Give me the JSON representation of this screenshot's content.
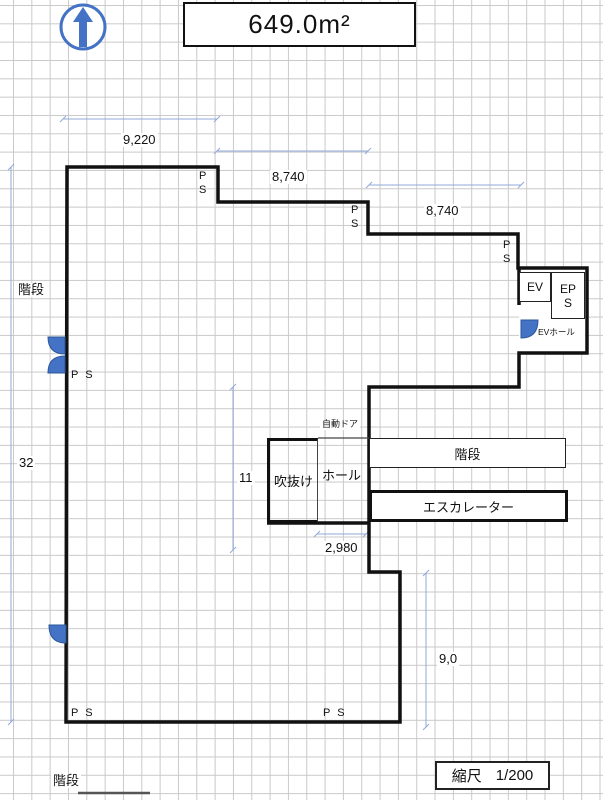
{
  "header": {
    "area_label": "649.0m²"
  },
  "scale": {
    "label": "縮尺",
    "value": "1/200"
  },
  "dimensions": {
    "top_left_width": "9,220",
    "top_middle_width": "8,740",
    "top_right_width": "8,740",
    "hall_width": "2,980",
    "left_height": "32",
    "atrium_height": "11",
    "lower_right_height": "9,0"
  },
  "rooms": {
    "stairs_upper_left": "階段",
    "stairs_right": "階段",
    "stairs_bottom": "階段",
    "escalator": "エスカレーター",
    "atrium": "吹抜け",
    "hall": "ホール",
    "automatic_door": "自動ドア",
    "elevator": "EV",
    "eps_line1": "EP",
    "eps_line2": "S",
    "ev_hall": "EVホール"
  },
  "shafts": {
    "p": "P",
    "s": "S",
    "pair": "P S"
  },
  "icons": {
    "compass": "north-arrow"
  },
  "colors": {
    "accent_blue": "#4472C4",
    "dimension_blue": "#92A9D9",
    "wall": "#111111",
    "grid": "#C9C9C9"
  }
}
